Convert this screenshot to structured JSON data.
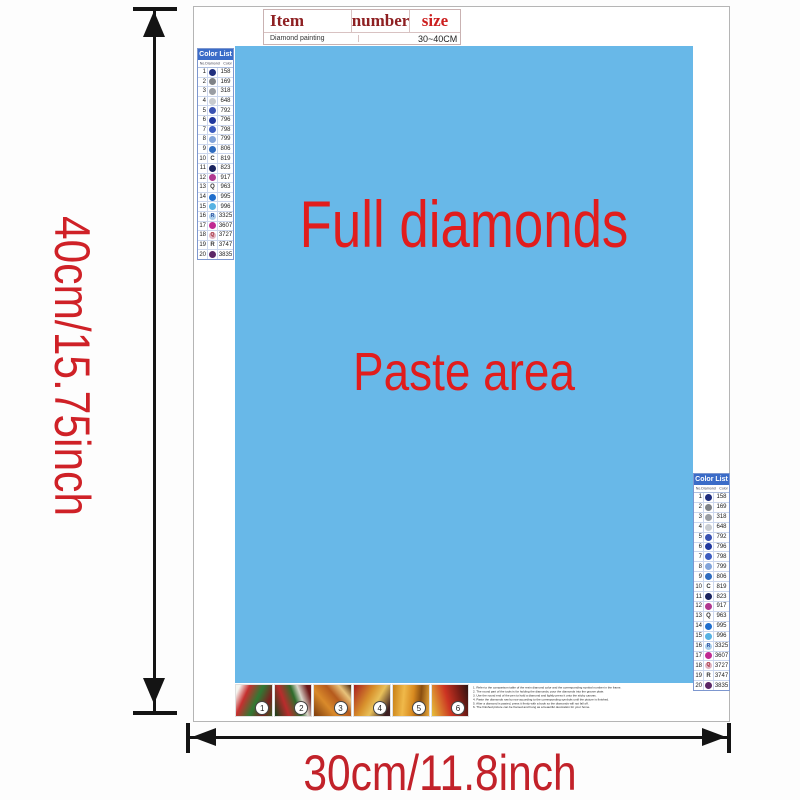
{
  "spec_table": {
    "headers": [
      "Item",
      "number",
      "size"
    ],
    "row": {
      "item": "Diamond painting",
      "number": "",
      "size": "30~40CM"
    }
  },
  "paste_area": {
    "line1": "Full diamonds",
    "line2": "Paste area",
    "bg_color": "#68b8e8",
    "text_color": "#e11d1d"
  },
  "dimensions": {
    "height_label": "40cm/15.75inch",
    "width_label": "30cm/11.8inch",
    "label_color": "#cf2127"
  },
  "color_list": {
    "title": "Color List",
    "columns": [
      "No.",
      "Diamond",
      "Color"
    ],
    "header_bg": "#3b6cc8",
    "rows": [
      {
        "no": "1",
        "sym": "",
        "dot": "#1f2e7e",
        "fg": "#ffffff",
        "code": "158"
      },
      {
        "no": "2",
        "sym": "",
        "dot": "#7e8287",
        "fg": "#ffffff",
        "code": "169"
      },
      {
        "no": "3",
        "sym": "",
        "dot": "#999da3",
        "fg": "#ffffff",
        "code": "318"
      },
      {
        "no": "4",
        "sym": "",
        "dot": "#c7cbd0",
        "fg": "#555555",
        "code": "648"
      },
      {
        "no": "5",
        "sym": "",
        "dot": "#3952b2",
        "fg": "#ffffff",
        "code": "792"
      },
      {
        "no": "6",
        "sym": "",
        "dot": "#20389e",
        "fg": "#ffffff",
        "code": "796"
      },
      {
        "no": "7",
        "sym": "",
        "dot": "#3c5cc0",
        "fg": "#ffffff",
        "code": "798"
      },
      {
        "no": "8",
        "sym": "",
        "dot": "#82a4da",
        "fg": "#ffffff",
        "code": "799"
      },
      {
        "no": "9",
        "sym": "",
        "dot": "#2e6cc0",
        "fg": "#ffffff",
        "code": "806"
      },
      {
        "no": "10",
        "sym": "C",
        "dot": "",
        "fg": "#333333",
        "code": "819"
      },
      {
        "no": "11",
        "sym": "",
        "dot": "#19235f",
        "fg": "#ffffff",
        "code": "823"
      },
      {
        "no": "12",
        "sym": "",
        "dot": "#b03890",
        "fg": "#ffffff",
        "code": "917"
      },
      {
        "no": "13",
        "sym": "Q",
        "dot": "",
        "fg": "#333333",
        "code": "963"
      },
      {
        "no": "14",
        "sym": "",
        "dot": "#1f6ecd",
        "fg": "#ffffff",
        "code": "995"
      },
      {
        "no": "15",
        "sym": "",
        "dot": "#57b2e3",
        "fg": "#ffffff",
        "code": "996"
      },
      {
        "no": "16",
        "sym": "R",
        "dot": "#aacdeb",
        "fg": "#2a4f9e",
        "code": "3325"
      },
      {
        "no": "17",
        "sym": "",
        "dot": "#c02a92",
        "fg": "#ffffff",
        "code": "3607"
      },
      {
        "no": "18",
        "sym": "Q",
        "dot": "#e0b4c2",
        "fg": "#a22735",
        "code": "3727"
      },
      {
        "no": "19",
        "sym": "R",
        "dot": "",
        "fg": "#333333",
        "code": "3747"
      },
      {
        "no": "20",
        "sym": "",
        "dot": "#5c2766",
        "fg": "#ffffff",
        "code": "3835"
      }
    ]
  },
  "steps": {
    "labels": [
      "1",
      "2",
      "3",
      "4",
      "5",
      "6"
    ]
  },
  "instructions": {
    "lines": [
      "1. Refer to the comparison table of the resin diamond color and the corresponding symbol number in the frame.",
      "2. The round part of the tools is for holding the diamonds; pour the diamonds into the groove plate.",
      "3. Use the round end of the pen to hold a diamond and lightly press it onto the sticky canvas.",
      "4. Paste the diamonds row by row according to the corresponding symbols until the picture is finished.",
      "5. After a diamond is pasted, press it firmly with a book so the diamonds will not fall off.",
      "6. The finished picture can be framed and hung as a beautiful decoration for your home."
    ]
  }
}
